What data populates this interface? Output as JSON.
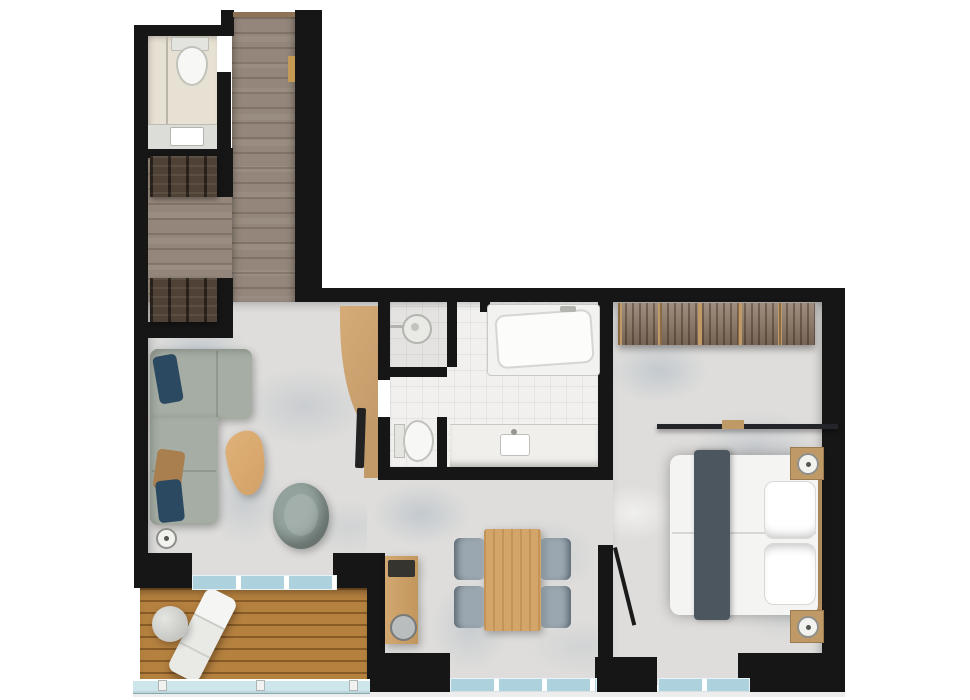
{
  "diagram": {
    "kind": "apartment-floor-plan",
    "rooms": [
      {
        "id": "wc",
        "furniture": [
          "toilet",
          "sink-counter"
        ]
      },
      {
        "id": "hallway",
        "furniture": [
          "entry-door"
        ]
      },
      {
        "id": "closet-nook",
        "furniture": [
          "wardrobe-top",
          "wardrobe-bottom"
        ]
      },
      {
        "id": "living-room",
        "furniture": [
          "corner-sofa",
          "pillows",
          "side-table",
          "armchair",
          "floor-lamp",
          "wood-panel-tv"
        ]
      },
      {
        "id": "bathroom",
        "furniture": [
          "shower",
          "toilet",
          "vanity-sink",
          "bathtub"
        ]
      },
      {
        "id": "dining-area",
        "furniture": [
          "dining-table",
          "chair",
          "chair",
          "chair",
          "chair",
          "sideboard"
        ]
      },
      {
        "id": "bedroom",
        "furniture": [
          "wardrobe",
          "double-bed",
          "bed-throw",
          "pillows",
          "nightstand",
          "nightstand",
          "partition-screen",
          "door"
        ]
      },
      {
        "id": "balcony",
        "furniture": [
          "lounge-chair",
          "round-side-table",
          "glass-railing"
        ]
      }
    ]
  },
  "palette": {
    "wall": "#161616",
    "floor_stone": "#dedddb",
    "floor_wood_hall": "#94867a",
    "floor_wc": "#e7e1d3",
    "floor_bath": "#f1f0ee",
    "deck": "#b5813f",
    "glass": "#aed2dd",
    "railing": "#cde6ec",
    "wardrobe_dark": "#4f4135",
    "wardrobe_bedroom": "#8a7663",
    "sofa": "#a5ada4",
    "pillow_navy": "#2c4962",
    "pillow_tan": "#a97f4f",
    "armchair": "#93a29c",
    "side_table_wood": "#d2a066",
    "dining_table": "#d3a568",
    "chair": "#9aa7b0",
    "sideboard": "#c2965c",
    "bed_white": "#f4f4f3",
    "bed_throw": "#4b565e",
    "nightstand": "#c09a66",
    "fixture_white": "#f7f7f6",
    "counter": "#dcdcd8",
    "tv_dark": "#222222",
    "media_wood": "#c29a68",
    "entry_door": "#8d7256"
  }
}
